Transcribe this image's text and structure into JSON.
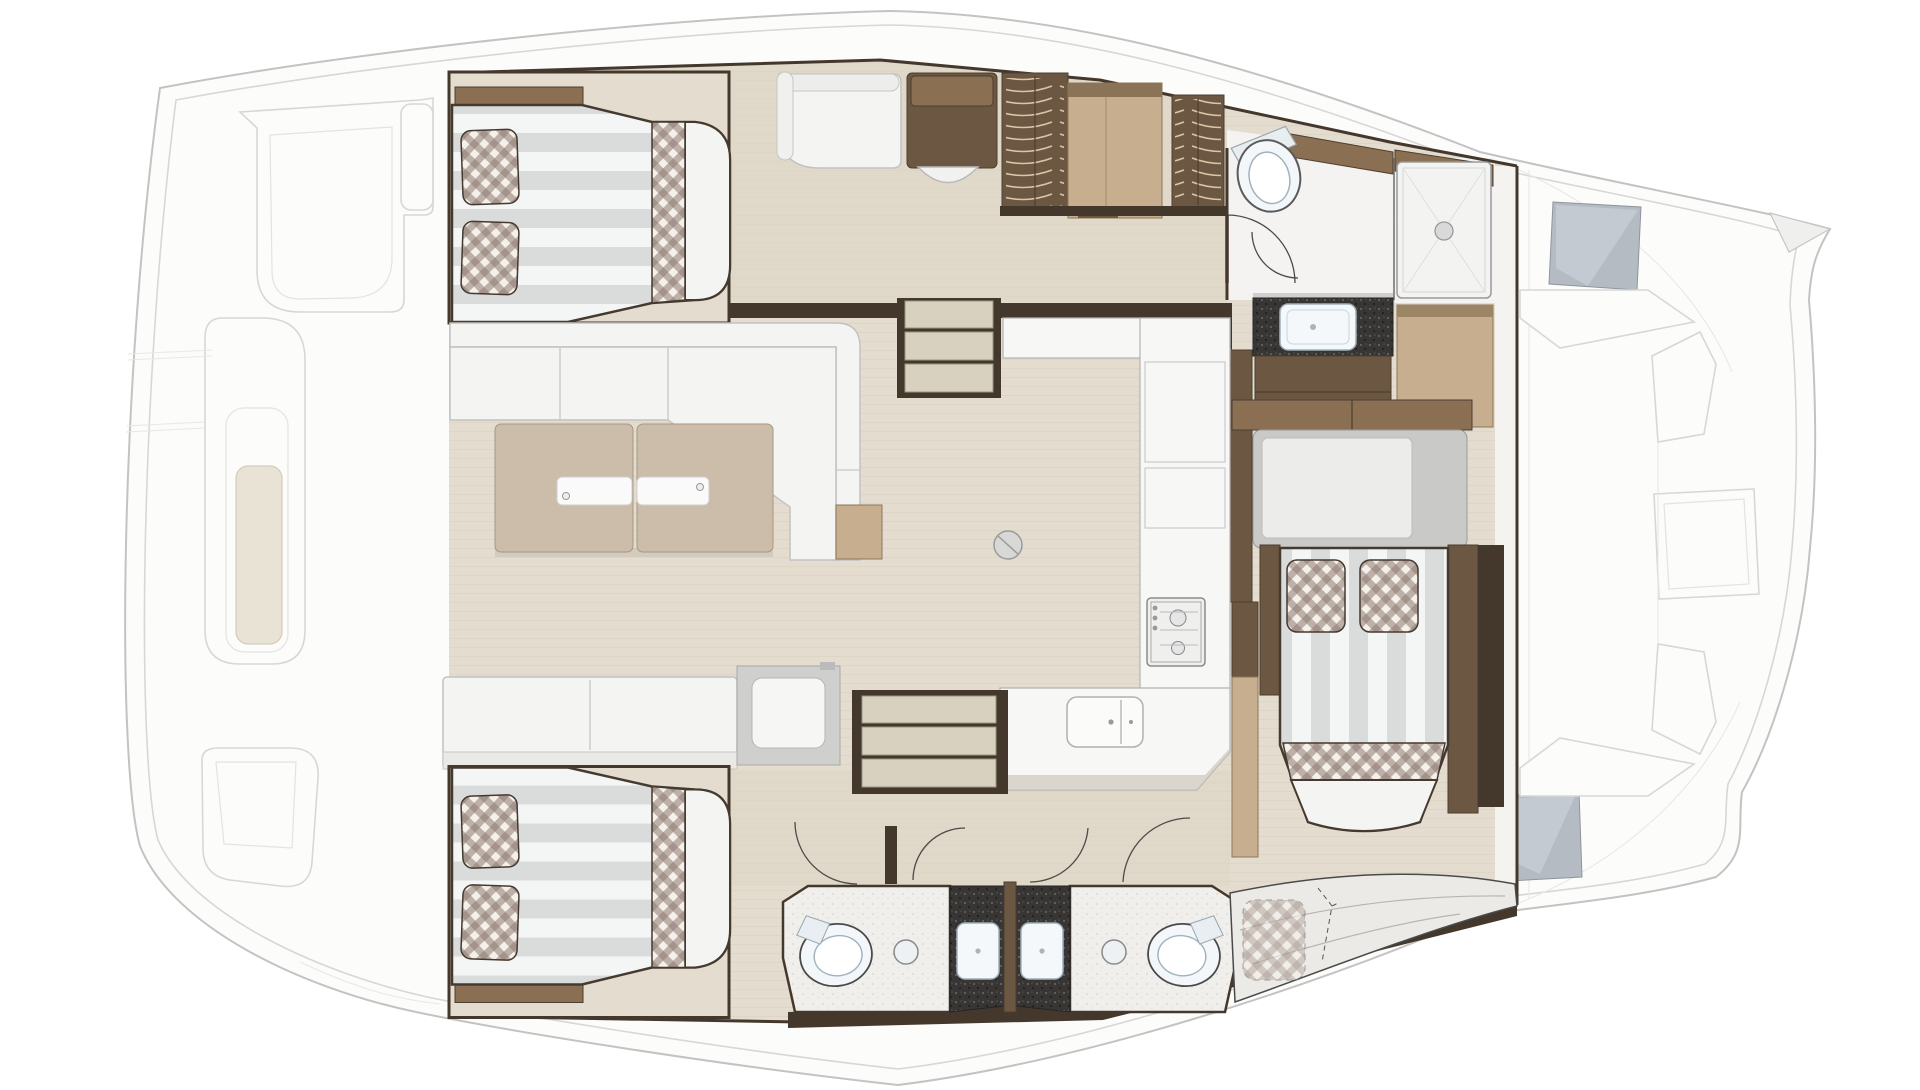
{
  "diagram": {
    "label": "Yacht interior layout floor plan (top view)",
    "type": "floor-plan",
    "text_visible_in_image": "none"
  },
  "palette": {
    "hull": "#fcfcfb",
    "hullLine": "#c3c3c3",
    "deckLine": "#d7d7d7",
    "floor": "#e4ddcf",
    "floorCorridor": "#ded6c5",
    "floorWhite": "#f4f3f1",
    "wallDark": "#44382c",
    "woodMid": "#8a6f52",
    "woodDark": "#6b5742",
    "woodDrawer": "#7b6248",
    "woodEdge": "#4c3f30",
    "tan": "#c6ae8f",
    "tanEdge": "#8d7658",
    "furnWhite": "#f4f4f2",
    "counter": "#f7f7f5",
    "blackCounter": "#383634",
    "plaidBase": "#f5f0ea",
    "plaidStripe": "#8d7b70",
    "stripeGray": "#dadcdc",
    "benchGray": "#eceae6",
    "hatchGray": "#b4bbc3",
    "toiletWhite": "#f3f7f9",
    "hangerLine": "#d9c6a8",
    "bedEdge": "#453a2f"
  },
  "zones": [
    {
      "id": "aft-deck-left",
      "name": "exterior deck (left end)",
      "furniture": [
        "sun-pad",
        "sun-pad-vertical",
        "deck-hatch",
        "seam-lines"
      ]
    },
    {
      "id": "cabin-top",
      "name": "guest cabin (top-left)",
      "furniture": [
        "double-berth-striped",
        "gingham-pillow",
        "gingham-pillow",
        "gingham-runner",
        "headboard-wood-bar"
      ]
    },
    {
      "id": "corridor-top",
      "name": "top passageway",
      "furniture": [
        "settee-white",
        "cabinet-brown",
        "pullout-stool",
        "hanging-locker",
        "locker-tan",
        "hanging-locker"
      ]
    },
    {
      "id": "bathroom-top",
      "name": "top bathroom + shower room",
      "furniture": [
        "toilet",
        "door-arc",
        "shower-tray-with-drain",
        "vanity-black-counter",
        "vanity-sink",
        "drawer-unit",
        "locker-tan"
      ]
    },
    {
      "id": "saloon",
      "name": "saloon",
      "furniture": [
        "l-shaped-sofa",
        "twin-leaf-table",
        "bench-sofa",
        "cool-box-seat",
        "side-table-tan",
        "floor-fitting-circle"
      ]
    },
    {
      "id": "galley",
      "name": "galley",
      "furniture": [
        "u-shaped-counter",
        "tall-locker-outline",
        "gas-hob-two-burner",
        "double-sink",
        "kick-shadow"
      ]
    },
    {
      "id": "stairs-top",
      "name": "companionway steps (up)",
      "furniture": [
        "three-steps"
      ]
    },
    {
      "id": "stairs-bottom",
      "name": "companionway steps (down)",
      "furniture": [
        "three-steps"
      ]
    },
    {
      "id": "cabin-bottom",
      "name": "guest cabin (bottom-left)",
      "furniture": [
        "double-berth-striped",
        "gingham-pillow",
        "gingham-pillow",
        "gingham-runner",
        "headboard-wood-bar"
      ]
    },
    {
      "id": "bathrooms-bottom",
      "name": "twin bathrooms (bottom-middle)",
      "furniture": [
        "toilet",
        "round-basin",
        "black-vanity-with-sink",
        "partition-wall",
        "black-vanity-with-sink",
        "round-basin",
        "toilet",
        "door-arcs"
      ]
    },
    {
      "id": "owner-cabin",
      "name": "owner cabin (right)",
      "furniture": [
        "island-berth-striped",
        "gingham-pillow",
        "gingham-pillow",
        "gingham-runner",
        "desk-gray",
        "wood-shelf-band",
        "wardrobe-wall",
        "curved-settee",
        "dashed-convertible-cushion",
        "door-arc"
      ]
    },
    {
      "id": "foredeck-right",
      "name": "exterior foredeck (right end)",
      "furniture": [
        "deck-hatch-gray",
        "deck-hatch-gray",
        "lounge-seat",
        "lounge-back",
        "deck-table",
        "lounge-seat",
        "bow-beak"
      ]
    }
  ]
}
